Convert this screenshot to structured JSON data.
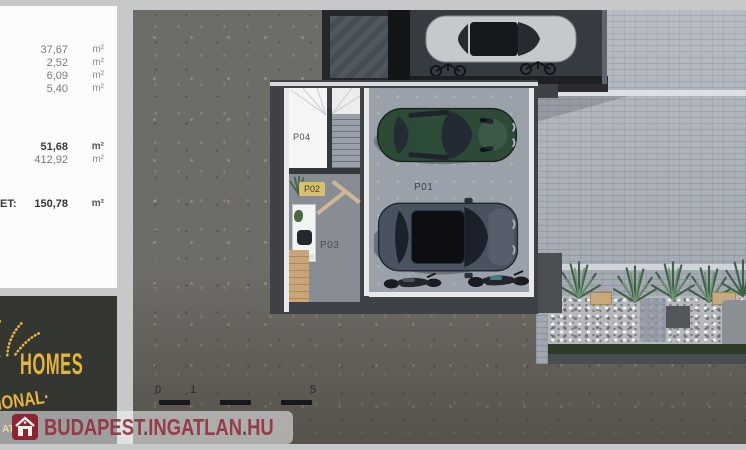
{
  "left_panel": {
    "area_rows": [
      {
        "value": "37,67",
        "unit": "m²"
      },
      {
        "value": "2,52",
        "unit": "m²"
      },
      {
        "value": "6,09",
        "unit": "m²"
      },
      {
        "value": "5,40",
        "unit": "m²"
      }
    ],
    "summary_rows": [
      {
        "value": "51,68",
        "unit": "m²"
      },
      {
        "value": "412,92",
        "unit": "m²"
      }
    ],
    "total_row": {
      "label": "ET:",
      "value": "150,78",
      "unit": "m²"
    }
  },
  "brand_panel": {
    "wordmark": "HOMES",
    "tagline": "IONAL·",
    "tagline2": "ATE"
  },
  "floorplan": {
    "room_labels": {
      "p01": "P01",
      "p02": "P02",
      "p03": "P03",
      "p04": "P04"
    },
    "scale_bar": {
      "tick0": "0",
      "tick1": "1",
      "tick5": "5"
    }
  },
  "watermark": {
    "t1": "BUDAPEST",
    "d1": ".",
    "t2": "INGATLAN",
    "d2": ".",
    "t3": "HU"
  },
  "colors": {
    "brand_gold": "#e7b53a",
    "watermark_red": "#942a3b",
    "brand_panel_dark": "#343631",
    "asphalt": "#6e6c66",
    "pavement": "#abb1bb",
    "garage_floor": "#9ba1ab",
    "car_green": "#2c4a37",
    "car_gray": "#49525f",
    "wall_dark": "#3e4145"
  }
}
